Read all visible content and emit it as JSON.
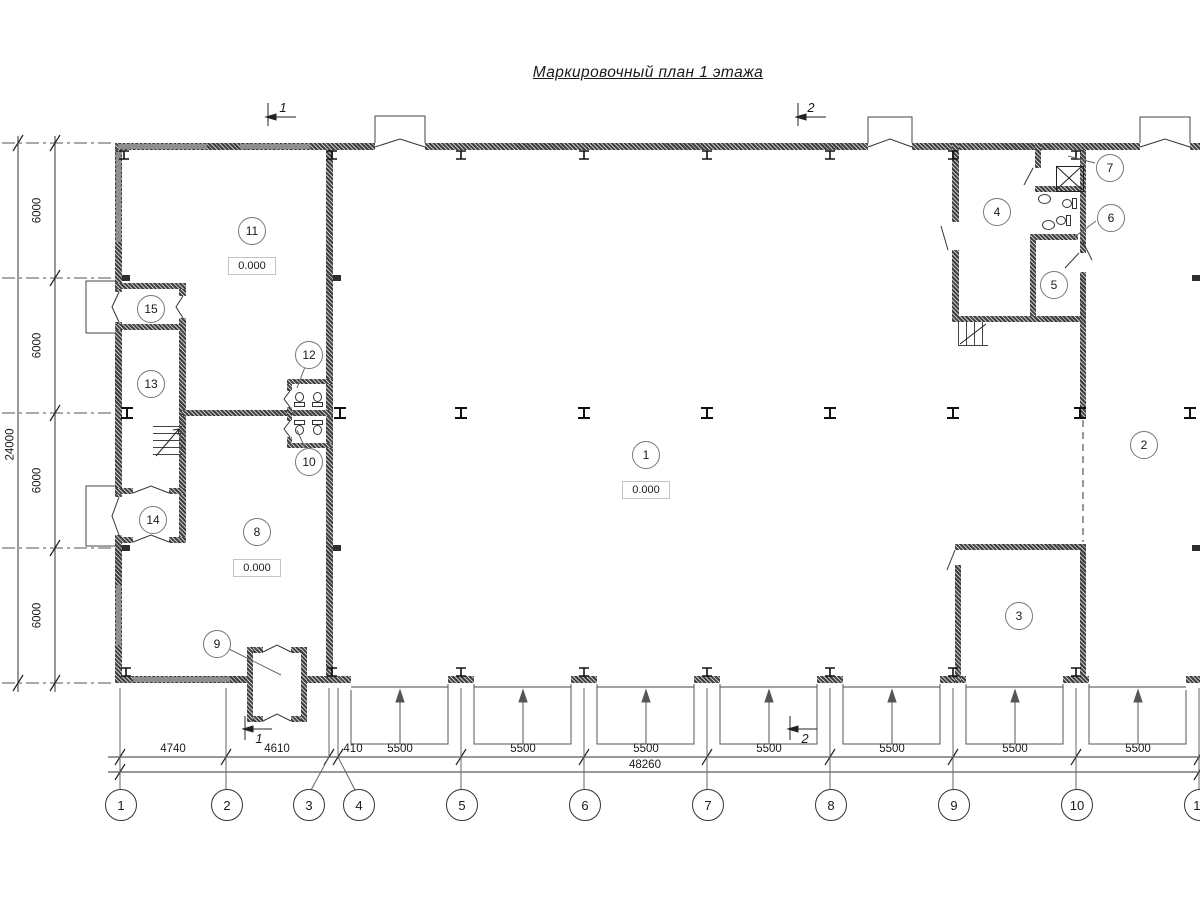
{
  "title": "Маркировочный план 1 этажа",
  "rooms": {
    "r1": "1",
    "r2": "2",
    "r3": "3",
    "r4": "4",
    "r5": "5",
    "r6": "6",
    "r7": "7",
    "r8": "8",
    "r9": "9",
    "r10": "10",
    "r11": "11",
    "r12": "12",
    "r13": "13",
    "r14": "14",
    "r15": "15"
  },
  "levels": {
    "room1": "0.000",
    "room8": "0.000",
    "room11": "0.000"
  },
  "axes": {
    "a1": "1",
    "a2": "2",
    "a3": "3",
    "a4": "4",
    "a5": "5",
    "a6": "6",
    "a7": "7",
    "a8": "8",
    "a9": "9",
    "a10": "10",
    "a11": "11"
  },
  "dims": {
    "d1": "4740",
    "d2": "4610",
    "d3": "410",
    "d4": "5500",
    "d5": "5500",
    "d6": "5500",
    "d7": "5500",
    "d8": "5500",
    "d9": "5500",
    "d10": "5500",
    "total": "48260",
    "v1": "6000",
    "v2": "6000",
    "v3": "6000",
    "v4": "6000",
    "vtotal": "24000"
  },
  "sections": {
    "top1": "1",
    "top2": "2",
    "bottom1": "1",
    "bottom2": "2"
  },
  "colors": {
    "wall": "#3f3f3f",
    "window": "#8e8e8e",
    "line": "#333333"
  }
}
